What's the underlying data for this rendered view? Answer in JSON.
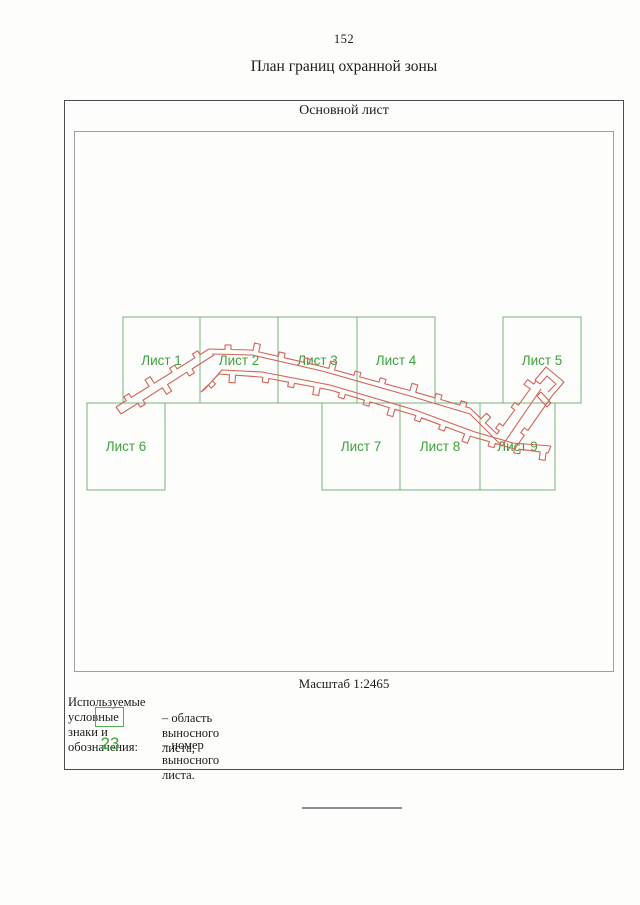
{
  "page": {
    "number": "152",
    "title": "План границ охранной зоны"
  },
  "main_sheet": {
    "title": "Основной лист",
    "scale": "Масштаб 1:2465"
  },
  "sheets": [
    {
      "label": "Лист 1"
    },
    {
      "label": "Лист 2"
    },
    {
      "label": "Лист 3"
    },
    {
      "label": "Лист 4"
    },
    {
      "label": "Лист 5"
    },
    {
      "label": "Лист 6"
    },
    {
      "label": "Лист 7"
    },
    {
      "label": "Лист 8"
    },
    {
      "label": "Лист 9"
    }
  ],
  "legend": {
    "header": "Используемые условные знаки и обозначения:",
    "area_item": {
      "text": "– область выносного листа;"
    },
    "number_item": {
      "sample": "23",
      "text": "– номер выносного листа."
    }
  },
  "colors": {
    "sheet_border_green": "#7cb27c",
    "sheet_label_green": "#3da23d",
    "zone_red": "#d2645a",
    "frame_gray": "#4a4d52"
  }
}
